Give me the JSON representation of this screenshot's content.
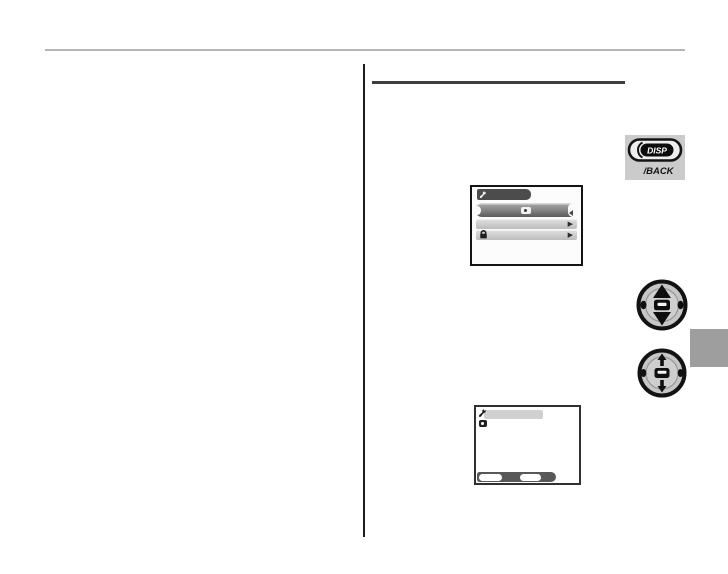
{
  "page": {
    "background": "#ffffff",
    "top_rule_color": "#b5b5b5",
    "column_divider_color": "#1c1c1c",
    "heading_underline_color": "#3e3e3e",
    "chapter_tab_color": "#9e9e9e"
  },
  "disp_back_button": {
    "plate_color": "#cbcbcb",
    "label_disp": "DISP",
    "label_back": "/BACK"
  },
  "menu_screen": {
    "badge": {
      "icon": "wrench-setup-icon",
      "color": "#4c4c4c"
    },
    "selected_row": {
      "icon": "camera-icon",
      "gradient_top": "#aaaaaa",
      "gradient_bottom": "#5c5c5c"
    },
    "rows": [
      {
        "icon": "",
        "arrow_glyph": "▶"
      },
      {
        "icon": "lock-icon",
        "arrow_glyph": "▶"
      }
    ],
    "row_color": "#cdcdcd"
  },
  "selector_buttons": {
    "updown": {
      "icon": "dpad-up-down-icon"
    },
    "menu_ok": {
      "icon": "dpad-menu-ok-icon"
    }
  },
  "confirm_screen": {
    "header_icon": "wrench-setup-icon",
    "header_bar_color": "#d0d0d0",
    "list_icon": "camera-back-icon",
    "footer_bar_color": "#585858",
    "footer_button_count": 2
  },
  "icons": {
    "disp-back-button-icon": "oval button with DISP label",
    "wrench-setup-icon": "wrench",
    "camera-icon": "camera",
    "lock-icon": "lock",
    "menu-row-arrow-icon": "▶",
    "dpad-up-down-icon": "4-way selector, up/down highlighted",
    "dpad-menu-ok-icon": "4-way selector with MENU/OK center",
    "camera-back-icon": "camera back"
  }
}
